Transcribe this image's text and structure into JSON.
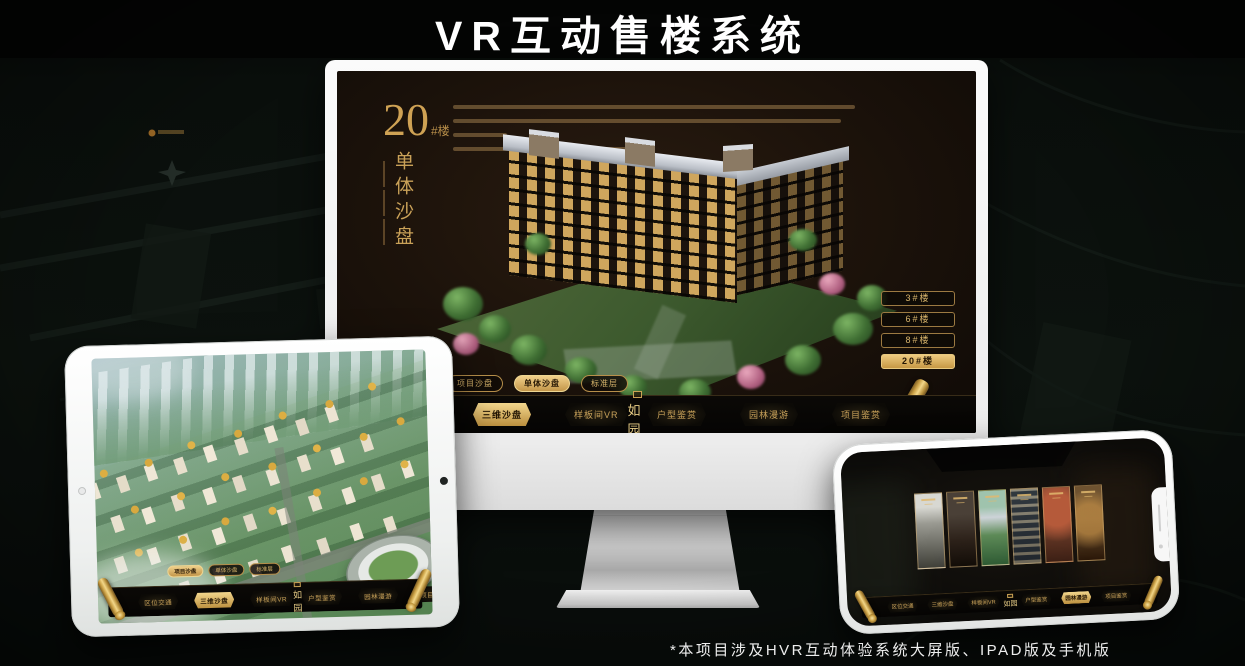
{
  "page": {
    "title": "VR互动售楼系统",
    "footnote": "*本项目涉及HVR互动体验系统大屏版、IPAD版及手机版"
  },
  "colors": {
    "background": "#0a0f0c",
    "gold": "#d4ac60",
    "gold_bright": "#f0d08a",
    "screen_brown": "#1d130b",
    "white": "#f2f2f2"
  },
  "monitor_app": {
    "building_no": "20",
    "building_no_suffix": "#楼",
    "building_label_vertical": "单体沙盘",
    "floor_buttons": [
      {
        "label": "3#楼",
        "active": false
      },
      {
        "label": "6#楼",
        "active": false
      },
      {
        "label": "8#楼",
        "active": false
      },
      {
        "label": "20#楼",
        "active": true
      }
    ],
    "sub_tabs": [
      {
        "label": "项目沙盘",
        "active": false
      },
      {
        "label": "单体沙盘",
        "active": true
      },
      {
        "label": "标准层",
        "active": false
      }
    ],
    "nav_left": [
      {
        "label": "区位交通",
        "active": false
      },
      {
        "label": "三维沙盘",
        "active": true
      },
      {
        "label": "样板间VR",
        "active": false
      }
    ],
    "logo": "如园",
    "nav_right": [
      {
        "label": "户型鉴赏",
        "active": false
      },
      {
        "label": "园林漫游",
        "active": false
      },
      {
        "label": "项目鉴赏",
        "active": false
      }
    ]
  },
  "tablet_app": {
    "sub_tabs": [
      {
        "label": "项目沙盘",
        "active": true
      },
      {
        "label": "单体沙盘",
        "active": false
      },
      {
        "label": "标准层",
        "active": false
      }
    ],
    "nav_left": [
      {
        "label": "区位交通",
        "active": false
      },
      {
        "label": "三维沙盘",
        "active": true
      },
      {
        "label": "样板间VR",
        "active": false
      }
    ],
    "logo": "如园",
    "nav_right": [
      {
        "label": "户型鉴赏",
        "active": false
      },
      {
        "label": "园林漫游",
        "active": false
      },
      {
        "label": "项目鉴赏",
        "active": false
      }
    ]
  },
  "phone_app": {
    "nav_left": [
      {
        "label": "区位交通",
        "active": false
      },
      {
        "label": "三维沙盘",
        "active": false
      },
      {
        "label": "样板间VR",
        "active": false
      }
    ],
    "logo": "如园",
    "nav_right": [
      {
        "label": "户型鉴赏",
        "active": false
      },
      {
        "label": "园林漫游",
        "active": true
      },
      {
        "label": "项目鉴赏",
        "active": false
      }
    ]
  }
}
